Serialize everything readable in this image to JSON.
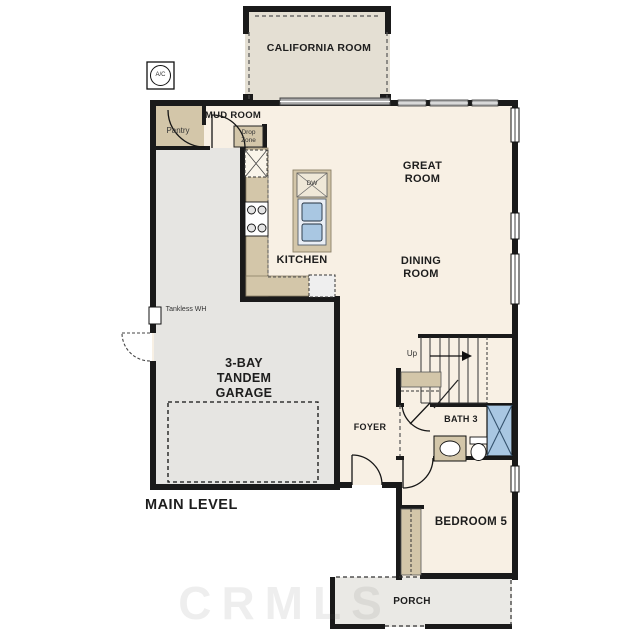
{
  "plan": {
    "level_label": "MAIN LEVEL",
    "watermark": "CRMLS",
    "rooms": {
      "california": "CALIFORNIA ROOM",
      "mud": "MUD ROOM",
      "pantry": "Pantry",
      "drop_zone": "Drop Zone",
      "great": "GREAT ROOM",
      "dining": "DINING ROOM",
      "kitchen": "KITCHEN",
      "garage": "3-BAY TANDEM GARAGE",
      "foyer": "FOYER",
      "bath": "BATH 3",
      "bedroom": "BEDROOM 5",
      "porch": "PORCH"
    },
    "annotations": {
      "ac_unit": "A/C",
      "tankless_wh": "Tankless WH",
      "stairs_up": "Up",
      "dishwasher": "DW"
    },
    "colors": {
      "wall": "#1a1a1a",
      "floor": "#f8f0e4",
      "garage_floor": "#e6e5e2",
      "counter": "#d3c6a9",
      "california_floor": "#e4dfd3",
      "porch_floor": "#eae9e5",
      "fixture_blue": "#a9c7e2"
    }
  }
}
